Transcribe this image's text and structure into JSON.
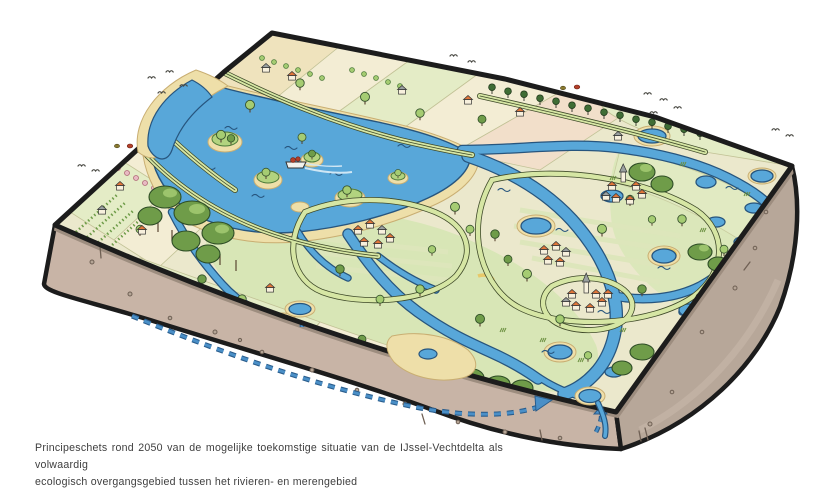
{
  "caption": {
    "line1": "Principeschets rond 2050 van de mogelijke toekomstige situatie van de IJssel-Vechtdelta als volwaardig",
    "line2": "ecologisch overgangsgebied tussen het rivieren- en merengebied"
  },
  "scene": {
    "type": "isometric-illustration",
    "subject": "IJssel-Vechtdelta rond 2050",
    "elements": [
      "lake-with-islands",
      "meandering-rivers",
      "dikes",
      "polder-fields",
      "orchards",
      "forests",
      "villages-with-church",
      "farmhouses",
      "cargo-boat",
      "birds",
      "groundwater-seepage-arrows",
      "earth-cross-section"
    ]
  },
  "palette": {
    "ink": "#1c1c1c",
    "water": "#58a7d9",
    "waterline": "#27557e",
    "land": "#ebe8cc",
    "wet": "#d8e6b6",
    "field1": "#f3edd4",
    "field2": "#e4ecc6",
    "field3": "#efe3bd",
    "field4": "#f2dfca",
    "sand": "#eedfa9",
    "sandline": "#c9ae72",
    "dike": "#d6e6a4",
    "dikeline": "#3f4a2a",
    "tree1": "#a5cc72",
    "tree2": "#6f9c49",
    "tree3": "#3f6d35",
    "trunk": "#5a4632",
    "wall": "#f7f0dd",
    "roof": "#e0763a",
    "roofgray": "#9aa0a0",
    "earthtop": "#9d8d7f",
    "earthfront": "#c8b4a6",
    "earthright": "#b7a799",
    "pebble": "#6f6054",
    "arrow": "#4a8fc7",
    "arrowdark": "#2a5d8c",
    "bird": "#4a4a44",
    "accent": "#b3402a",
    "blossom": "#e8b9c2",
    "text": "#3e3e3e"
  }
}
